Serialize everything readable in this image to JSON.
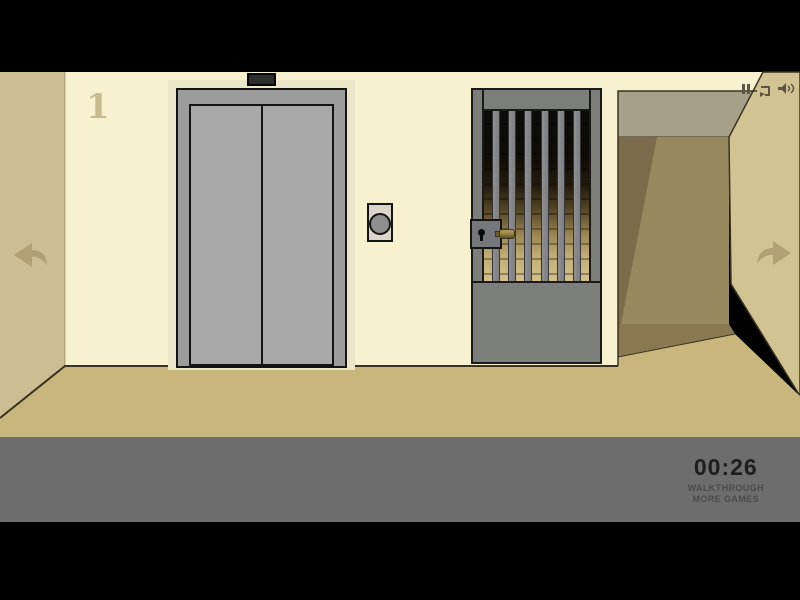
{
  "hud": {
    "floor_number": "1",
    "timer": "00:26",
    "walkthrough_label": "WALKTHROUGH",
    "more_games_label": "MORE GAMES"
  },
  "icons": {
    "top_right": [
      "pause-icon",
      "replay-icon",
      "sound-icon"
    ],
    "navigation": [
      "arrow-left-icon",
      "arrow-right-icon"
    ]
  },
  "scene": {
    "elements": [
      "elevator",
      "elevator-call-button",
      "jail-gate",
      "gate-lock",
      "corridor-opening"
    ],
    "gate": {
      "bar_count": 6
    },
    "palette": {
      "wall": "#f8f1cf",
      "wall-left": "#cdbd92",
      "wall-right": "#d2c392",
      "ceiling": "#a7a088",
      "corridor": "#97885e",
      "corridor-shadow": "#7b6c4b",
      "corridor-floor": "#8a7950",
      "floor": "#c8b67d",
      "halo": "#ece6c8",
      "line": "#3a3322",
      "outline": "#141414",
      "elev-frame": "#9c9c9c",
      "elev-door": "#a9a9a9",
      "indicator": "#2d2d2d",
      "panel-face": "#dad6ca",
      "panel-button": "#8e8e8e",
      "gate": "#7c7e7b",
      "gate-outline": "#1a1a1a",
      "lock-box": "#75777a",
      "hud-bar": "#6d6d6d",
      "timer": "#1e1e1e",
      "link": "#4b4b4b",
      "numeral": "#c9ba8d",
      "arrow": "#b0a074",
      "icon": "#5c5545"
    }
  }
}
